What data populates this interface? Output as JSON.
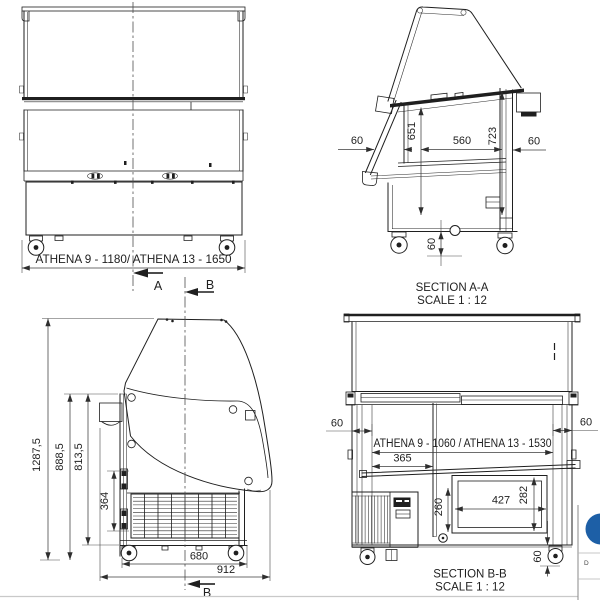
{
  "colors": {
    "ink": "#1f1f1f",
    "logo_blue": "#1d5fa6",
    "frame_gray": "#c9c9c9"
  },
  "front_view": {
    "width_dim": "ATHENA 9  - 1180/ ATHENA 13  - 1650",
    "cut_label_a": "A",
    "cut_label_b": "B"
  },
  "section_aa": {
    "title": "SECTION A-A",
    "scale": "SCALE 1 : 12",
    "dim_left_gap": "60",
    "dim_front_height": "651",
    "dim_inner_width": "560",
    "dim_back_height": "723",
    "dim_right_gap": "60",
    "dim_floor_clearance": "60"
  },
  "side_view": {
    "dim_total_height": "1287,5",
    "dim_body_height": "888,5",
    "dim_inner_height": "813,5",
    "dim_bracket_span": "364",
    "dim_base_depth": "680",
    "dim_total_depth": "912",
    "cut_label_b": "B"
  },
  "section_bb": {
    "title": "SECTION B-B",
    "scale": "SCALE 1 : 12",
    "dim_left_wall": "60",
    "dim_right_wall": "60",
    "dim_inner_width": "ATHENA 9 - 1060 / ATHENA 13 - 1530",
    "dim_shelf_depth": "365",
    "dim_well_depth": "260",
    "dim_tub_width": "427",
    "dim_tub_height": "282",
    "dim_floor_clearance": "60"
  },
  "title_block": {
    "cell_label": "D"
  }
}
